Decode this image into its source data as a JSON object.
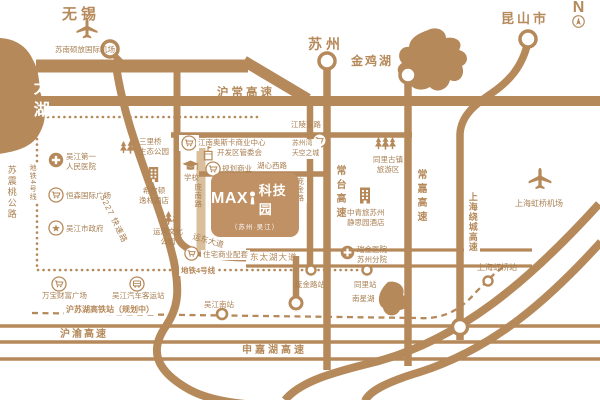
{
  "map": {
    "compass_letter": "N",
    "colors": {
      "brand": "#b5895a",
      "road_light": "#d9bf9b",
      "project_box": "#bf9164",
      "label_text": "#a87f52"
    },
    "project": {
      "logo": "MAX",
      "logo_mark_icon": "flask-mark",
      "name": "科技园",
      "subtitle": "（苏州·吴江）"
    },
    "cities": {
      "wuxi": "无锡",
      "suzhou": "苏州",
      "kunshan": "昆山市"
    },
    "lakes": {
      "taihu": "太湖",
      "jinji": "金鸡湖",
      "nanxing": "南星湖"
    },
    "airports": {
      "sunan": "苏南硕放国际机场",
      "hongqiao": "上海虹桥机场"
    },
    "expressways": {
      "huchang": "沪常高速",
      "changtai": "常台高速",
      "changjia": "常嘉高速",
      "raocheng": "上海绕城高速",
      "huyu": "沪渝高速",
      "shenjiahu": "申嘉湖高速"
    },
    "roads": {
      "s227": "S227 快速路",
      "suzhentao": "苏震桃公路",
      "jiangling": "江陵东路",
      "huxin": "湖心西路",
      "pangnan": "庞南路",
      "pangjin": "庞金路",
      "dongtaihu": "东太湖大道",
      "yundong": "运东大道"
    },
    "rail": {
      "metro4_v": "地铁4号线",
      "metro4_h": "地铁4号线",
      "pangjin_station": "庞金路站",
      "tongli_station": "同里站",
      "husuhu": "沪苏湖高铁站（规划中）",
      "wujiang_south_station": "吴江南站",
      "hongqiao_station": "上海虹桥站"
    },
    "pois": {
      "hospital1": "吴江第一\n人民医院",
      "hengsen": "恒森国际广场",
      "government": "吴江市政府",
      "sanliqiao": "三里桥\n生态公园",
      "hilton": "希尔顿\n逸林酒店",
      "school": "学校",
      "yunhe": "运河文化\n公园",
      "oscar": "江南奥斯卡商业中心",
      "kaifaqu": "开发区管委会",
      "guihua": "规划商业",
      "skycity": "苏州湾\n天空之城",
      "tongli_scenic": "同里古镇\n旅游区",
      "jingsiyuan": "中青旅苏州\n静思园酒店",
      "ruijin": "瑞金医院\n苏州分院",
      "wanbao": "万宝财富广场",
      "bus": "吴江汽车客运站",
      "zhuzhai": "住宅商业配套"
    },
    "icon_legend": {
      "hospital_icon": "white-cross-in-filled-circle",
      "shopping_icon": "cart-in-ring-circle",
      "government_icon": "star-in-ring-circle",
      "bus_icon": "bus-in-ring-circle",
      "park_icon": "pine-trees",
      "hotel_icon": "building-with-windows",
      "committee_icon": "building-with-flag",
      "school_icon": "graduation-cap",
      "airport_icon": "airplane",
      "station_icon": "ring-circle",
      "compass_icon": "north-arrow-in-circle"
    }
  }
}
